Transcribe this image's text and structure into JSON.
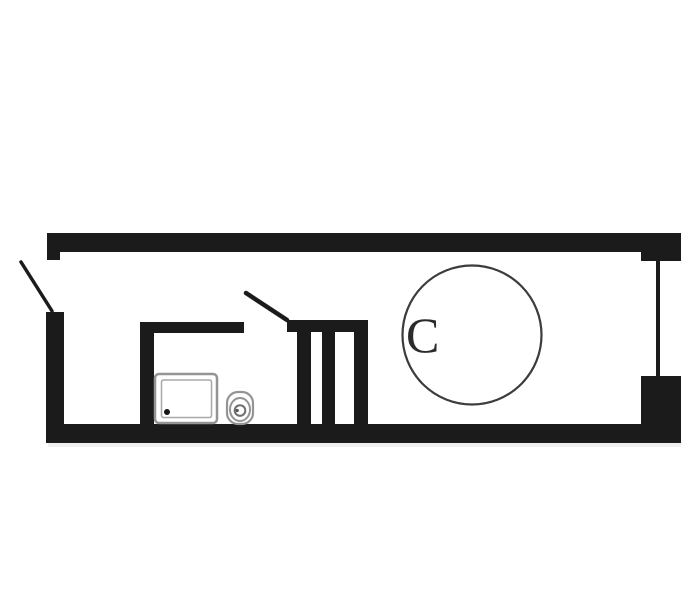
{
  "plan": {
    "title": "studio-apartment-floor-plan",
    "room_label": "C",
    "colors": {
      "background": "#ffffff",
      "wall": "#1b1b1b",
      "fixture_outline": "#949494",
      "fixture_inner_outline": "#a8a8a8",
      "toilet_inner_outline": "#6f6f6f",
      "table_outline": "#3c3c3c",
      "label_text": "#2b2b2b",
      "drain_dot": "#161616",
      "wall_shadow": "#dcdcdc"
    },
    "elements": {
      "walls": [
        "top-wall",
        "left-wall",
        "bottom-wall",
        "right-window-jamb-top",
        "right-window-jamb-bottom",
        "bathroom-wall-left",
        "bathroom-wall-top",
        "shaft-top-wall",
        "shaft-partition-1",
        "shaft-partition-2",
        "shaft-partition-3"
      ],
      "openings": [
        "entry-door-swing",
        "bathroom-door-swing",
        "window"
      ],
      "fixtures": [
        "shower-tray",
        "drain-dot",
        "toilet",
        "round-table"
      ]
    }
  }
}
